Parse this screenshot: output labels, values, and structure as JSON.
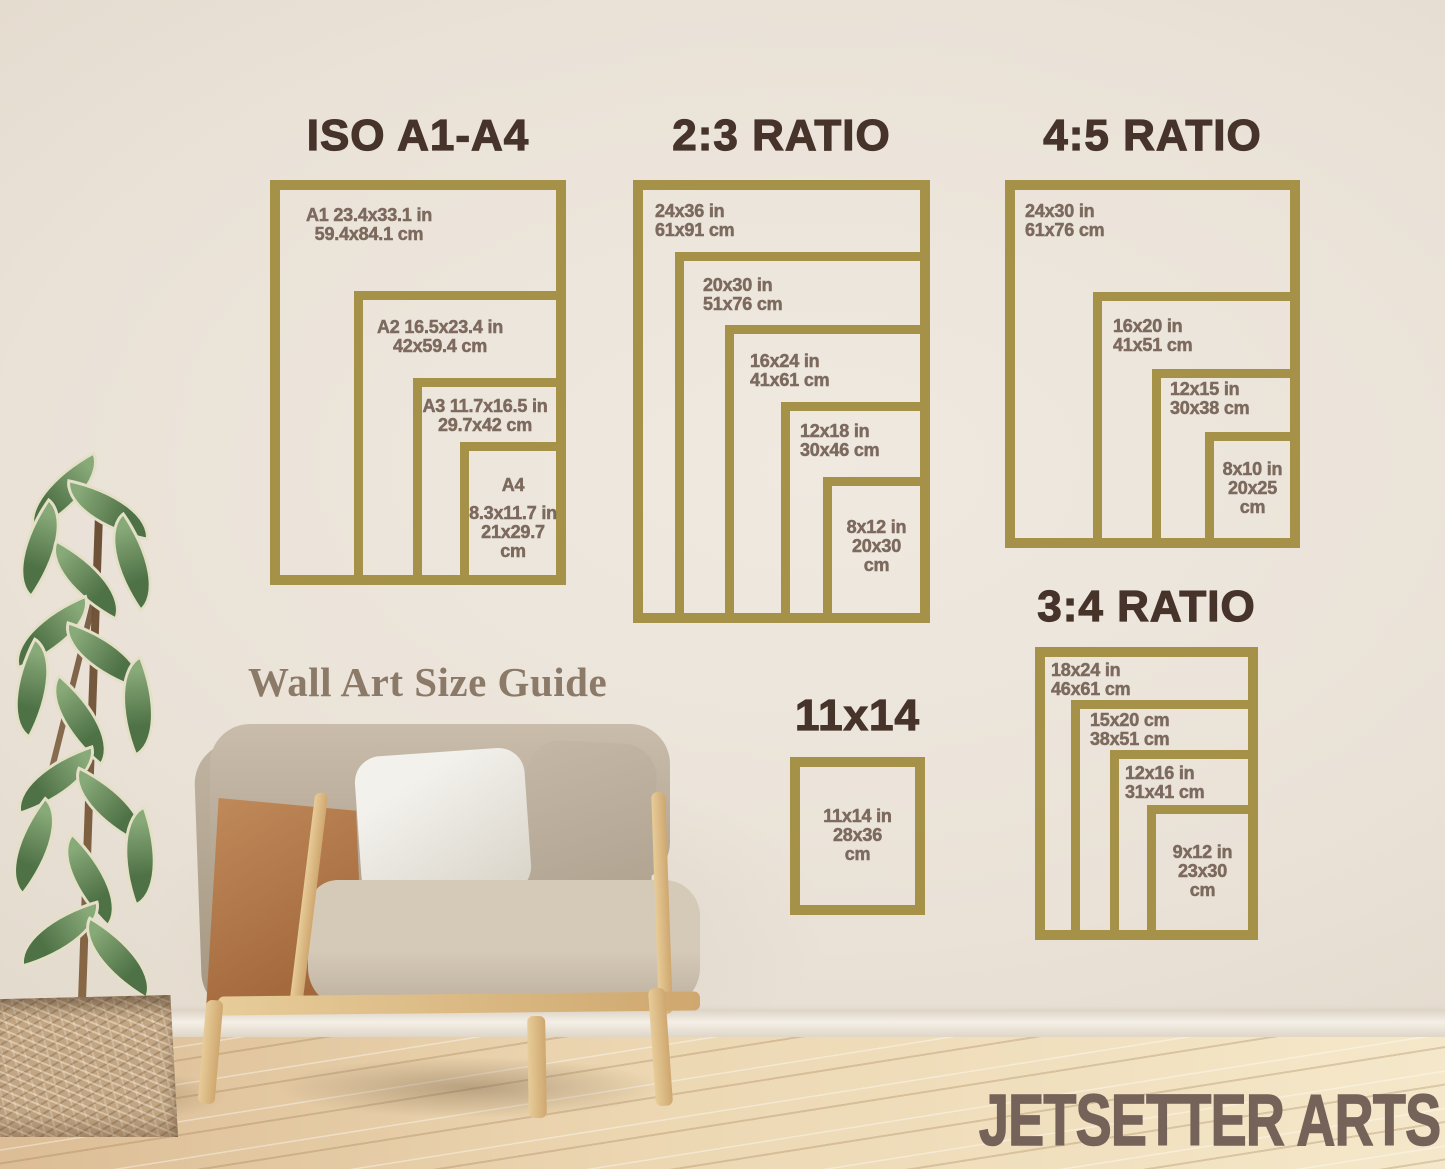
{
  "colors": {
    "frame_gold": "#a59248",
    "title_brown": "#46332a",
    "label_brown": "#7d6a5e",
    "caption_brown": "#8c7a69",
    "watermark_brown": "#75635a"
  },
  "caption": "Wall Art Size Guide",
  "watermark": "JETSETTER ARTS",
  "sections": [
    {
      "title": "ISO A1-A4",
      "frames": [
        {
          "lines": [
            "A1 23.4x33.1 in",
            "59.4x84.1 cm"
          ]
        },
        {
          "lines": [
            "A2 16.5x23.4 in",
            "42x59.4 cm"
          ]
        },
        {
          "lines": [
            "A3 11.7x16.5 in",
            "29.7x42 cm"
          ]
        },
        {
          "lines": [
            "A4",
            "8.3x11.7 in",
            "21x29.7",
            "cm"
          ]
        }
      ]
    },
    {
      "title": "2:3 RATIO",
      "frames": [
        {
          "lines": [
            "24x36 in",
            "61x91 cm"
          ]
        },
        {
          "lines": [
            "20x30 in",
            "51x76 cm"
          ]
        },
        {
          "lines": [
            "16x24 in",
            "41x61 cm"
          ]
        },
        {
          "lines": [
            "12x18 in",
            "30x46 cm"
          ]
        },
        {
          "lines": [
            "8x12 in",
            "20x30",
            "cm"
          ]
        }
      ]
    },
    {
      "title": "4:5 RATIO",
      "frames": [
        {
          "lines": [
            "24x30 in",
            "61x76 cm"
          ]
        },
        {
          "lines": [
            "16x20 in",
            "41x51 cm"
          ]
        },
        {
          "lines": [
            "12x15 in",
            "30x38 cm"
          ]
        },
        {
          "lines": [
            "8x10 in",
            "20x25",
            "cm"
          ]
        }
      ]
    },
    {
      "title": "3:4 RATIO",
      "frames": [
        {
          "lines": [
            "18x24 in",
            "46x61 cm"
          ]
        },
        {
          "lines": [
            "15x20 cm",
            "38x51 cm"
          ]
        },
        {
          "lines": [
            "12x16 in",
            "31x41 cm"
          ]
        },
        {
          "lines": [
            "9x12 in",
            "23x30",
            "cm"
          ]
        }
      ]
    },
    {
      "title": "11x14",
      "frames": [
        {
          "lines": [
            "11x14 in",
            "28x36",
            "cm"
          ]
        }
      ]
    }
  ]
}
